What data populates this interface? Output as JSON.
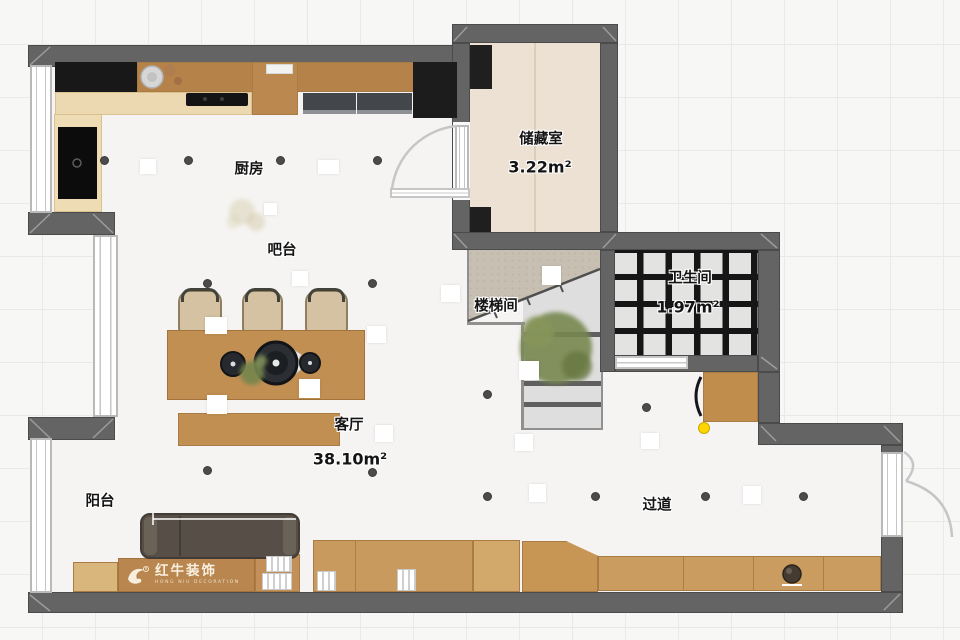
{
  "type": "floor-plan",
  "rooms": {
    "kitchen": {
      "label": "厨房"
    },
    "bar": {
      "label": "吧台"
    },
    "storage": {
      "label": "储藏室",
      "area": "3.22m²"
    },
    "stairwell": {
      "label": "楼梯间"
    },
    "bathroom": {
      "label": "卫生间",
      "area": "1.97m²"
    },
    "living": {
      "label": "客厅",
      "area": "38.10m²"
    },
    "balcony": {
      "label": "阳台"
    },
    "hallway": {
      "label": "过道"
    }
  },
  "watermark": {
    "brand": "红牛装饰",
    "subtitle": "HONG NIU DECORATION"
  },
  "colors": {
    "wall": "#646464",
    "wood": "#c99a5e",
    "floor": "#f5f4f2",
    "storage_floor": "#ece1d3",
    "bath_tile_grid": "#161616",
    "accent_dot": "#ffd400"
  }
}
